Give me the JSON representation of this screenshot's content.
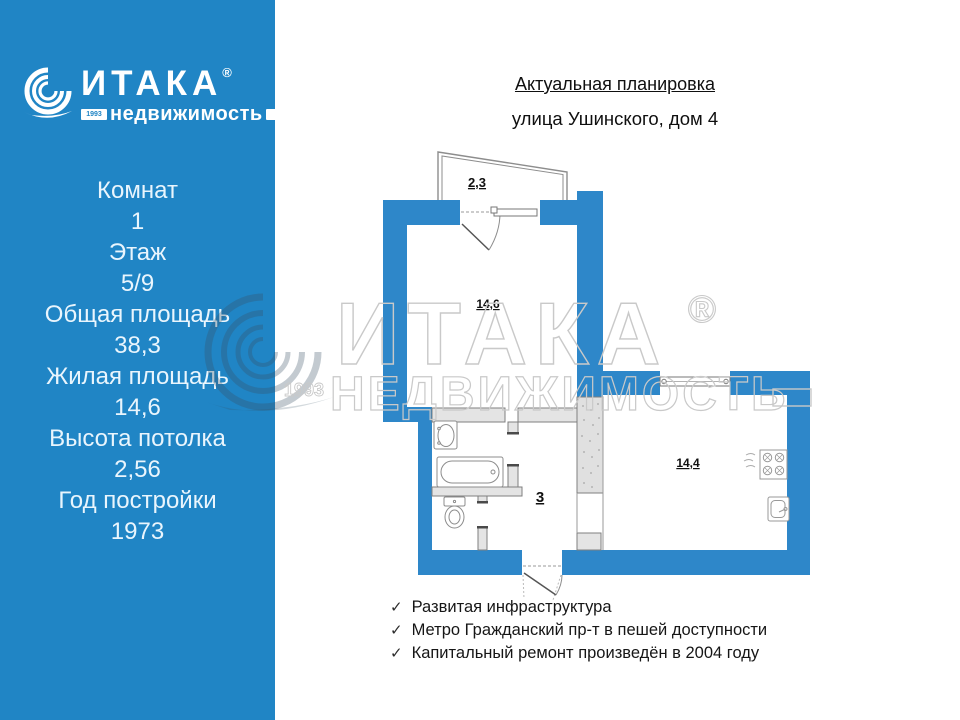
{
  "colors": {
    "sidebar_blue": "#2085c5",
    "wall_blue": "#2e87c9",
    "partition_gray": "#e4e4e4",
    "watermark_gray": "#c9c9c9",
    "text_on_blue": "#e9f5fd"
  },
  "sidebar": {
    "logo": {
      "brand": "ИТАКА",
      "registered": "®",
      "year": "1993",
      "sub": "недвижимость"
    },
    "stats": [
      {
        "label": "Комнат",
        "value": "1"
      },
      {
        "label": "Этаж",
        "value": "5/9"
      },
      {
        "label": "Общая площадь",
        "value": "38,3"
      },
      {
        "label": "Жилая площадь",
        "value": "14,6"
      },
      {
        "label": "Высота потолка",
        "value": "2,56"
      },
      {
        "label": "Год постройки",
        "value": "1973"
      }
    ]
  },
  "header": {
    "title": "Актуальная планировка",
    "subtitle": "улица Ушинского, дом 4"
  },
  "floorplan": {
    "rooms": {
      "balcony_area": "2,3",
      "living_area": "14,6",
      "hallway_area": "3",
      "kitchen_area": "14,4"
    }
  },
  "watermark": {
    "brand": "ИТАКА",
    "registered": "®",
    "year": "1993",
    "sub": "НЕДВИЖИМОСТЬ"
  },
  "features": {
    "check": "✓",
    "items": [
      "Развитая инфраструктура",
      "Метро Гражданский пр-т в пешей доступности",
      "Капитальный ремонт произведён в 2004 году"
    ]
  }
}
